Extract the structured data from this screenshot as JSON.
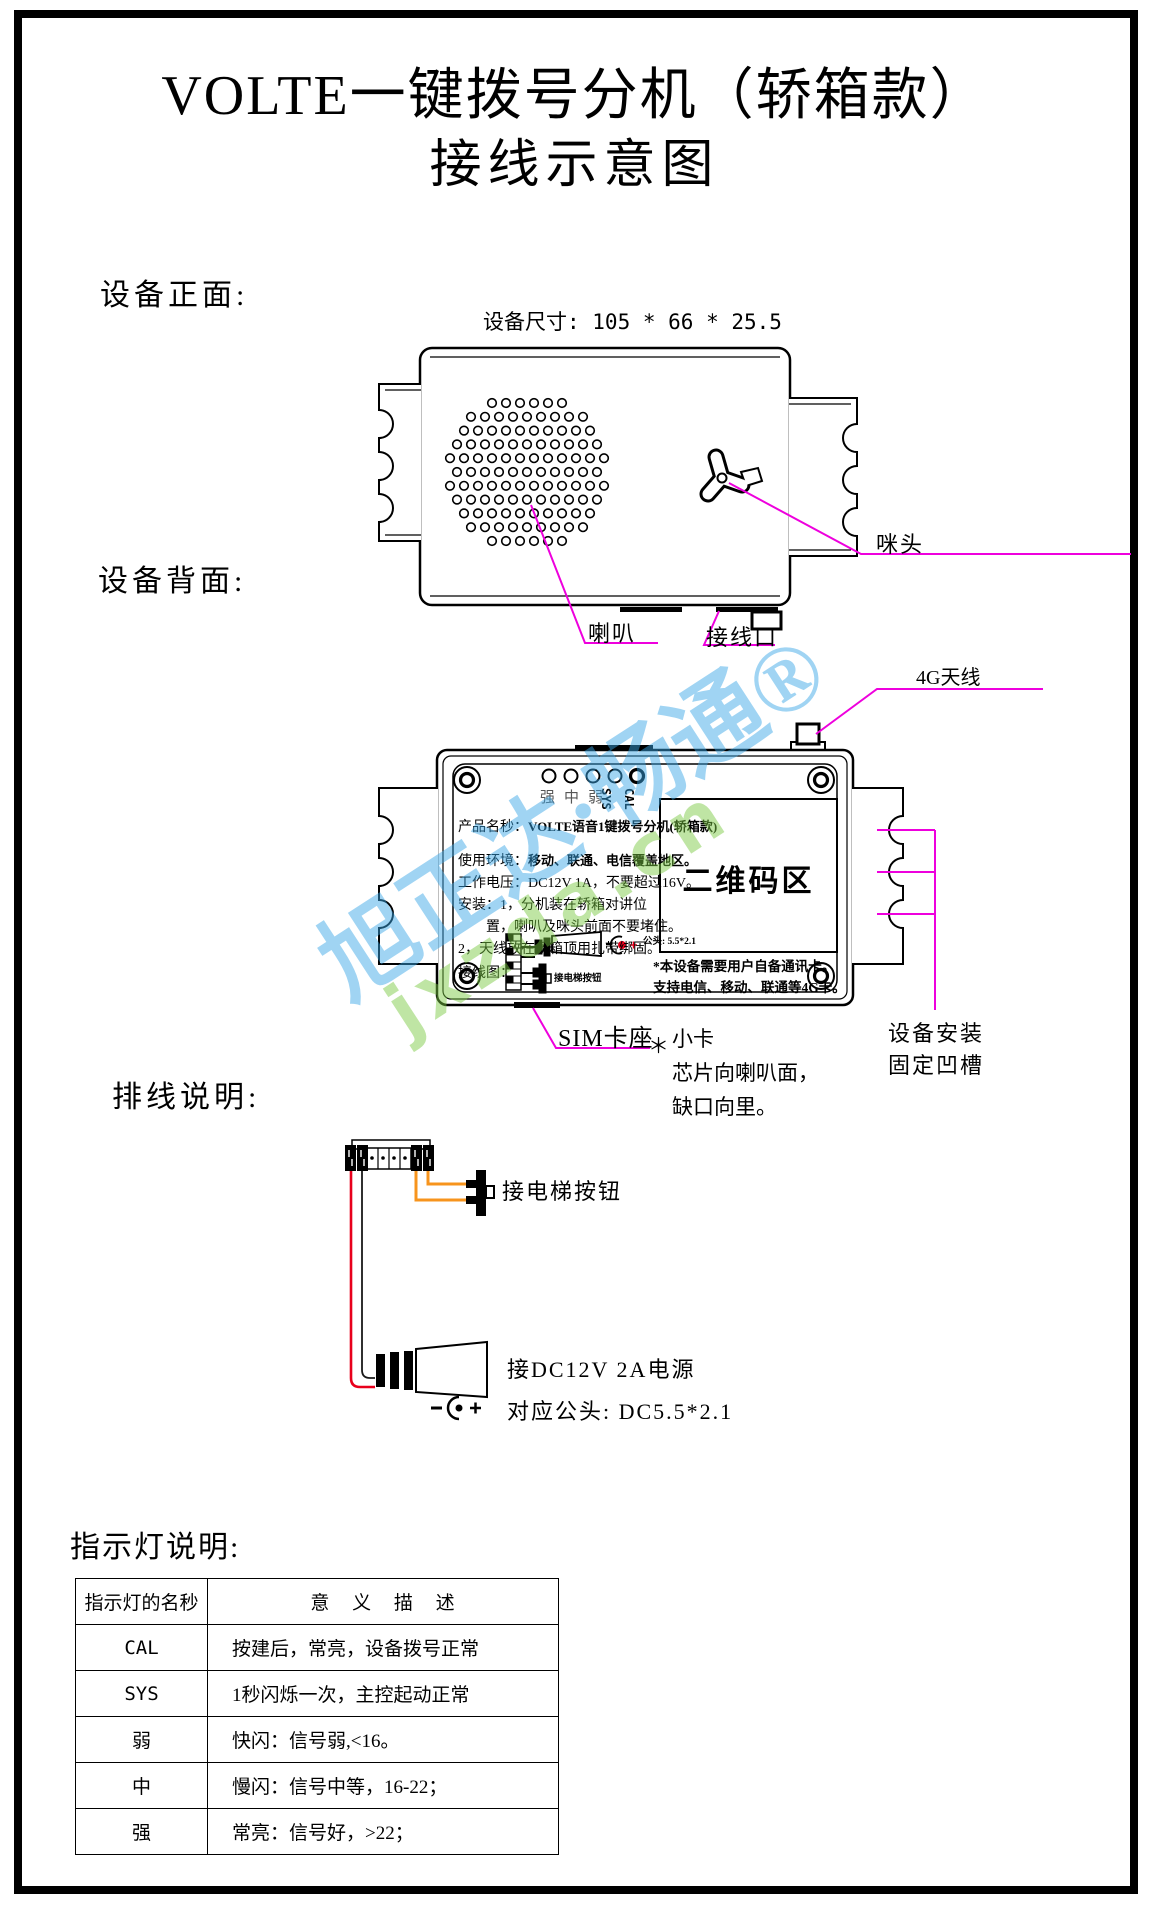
{
  "page_title": {
    "line1": "VOLTE一键拨号分机（轿箱款）",
    "line2": "接线示意图"
  },
  "front": {
    "heading": "设备正面:",
    "dimensions": "设备尺寸: 105 * 66 * 25.5",
    "speaker_label": "喇叭",
    "wiring_port_label": "接线口",
    "mic_label": "咪头"
  },
  "back": {
    "heading": "设备背面:",
    "antenna_label": "4G天线",
    "led_signal_label": "强中弱",
    "led_sys_label": "SYS",
    "led_cal_label": "CAL",
    "label": {
      "product_pre": "产品名秒：",
      "product": "VOLTE语音1键拨号分机(轿箱款)",
      "env_pre": "使用环境：",
      "env": "移动、联通、电信覆盖地区。",
      "volt_pre": "工作电压：",
      "volt": "DC12V 1A，不要超过16V。",
      "install1": "安装：1，分机装在轿箱对讲位",
      "install2": "置，喇叭及咪头前面不要堵住。",
      "install3": "2，天线放在轿箱顶用扎带绑固。",
      "wiring_pre": "接线图：",
      "plug_note": "公头: 5.5*2.1",
      "btn_note": "接电梯按钮"
    },
    "qr_label": "二维码区",
    "sim_card_note1": "*本设备需要用户自备通讯卡。",
    "sim_card_note2": "支持电信、移动、联通等4G卡。",
    "sim_callout_title": "SIM卡座",
    "sim_star": "＊",
    "sim_l1": "小卡",
    "sim_l2": "芯片向喇叭面，",
    "sim_l3": "缺口向里。",
    "groove_l1": "设备安装",
    "groove_l2": "固定凹槽"
  },
  "wiring": {
    "heading": "排线说明:",
    "button_label": "接电梯按钮",
    "power_label": "接DC12V 2A电源",
    "plug_label": "对应公头: DC5.5*2.1",
    "wire_colors": {
      "positive": "#e8001c",
      "ground": "#1a1a1a",
      "button": "#f7941d"
    }
  },
  "indicator": {
    "heading": "指示灯说明:",
    "col1": "指示灯的名秒",
    "col2": "意 义 描 述",
    "rows": [
      {
        "name": "CAL",
        "desc": "按建后，常亮，设备拨号正常"
      },
      {
        "name": "SYS",
        "desc": "1秒闪烁一次，主控起动正常"
      },
      {
        "name": "弱",
        "desc": "快闪：信号弱,<16。"
      },
      {
        "name": "中",
        "desc": "慢闪：信号中等，16-22；"
      },
      {
        "name": "强",
        "desc": "常亮：信号好，>22；"
      }
    ]
  },
  "watermark": {
    "cn": "旭正达·畅通®",
    "en": "jxzda.cn",
    "blue": "#3aa7e8",
    "green": "#7ac943"
  },
  "colors": {
    "callout": "#ee00dd"
  }
}
